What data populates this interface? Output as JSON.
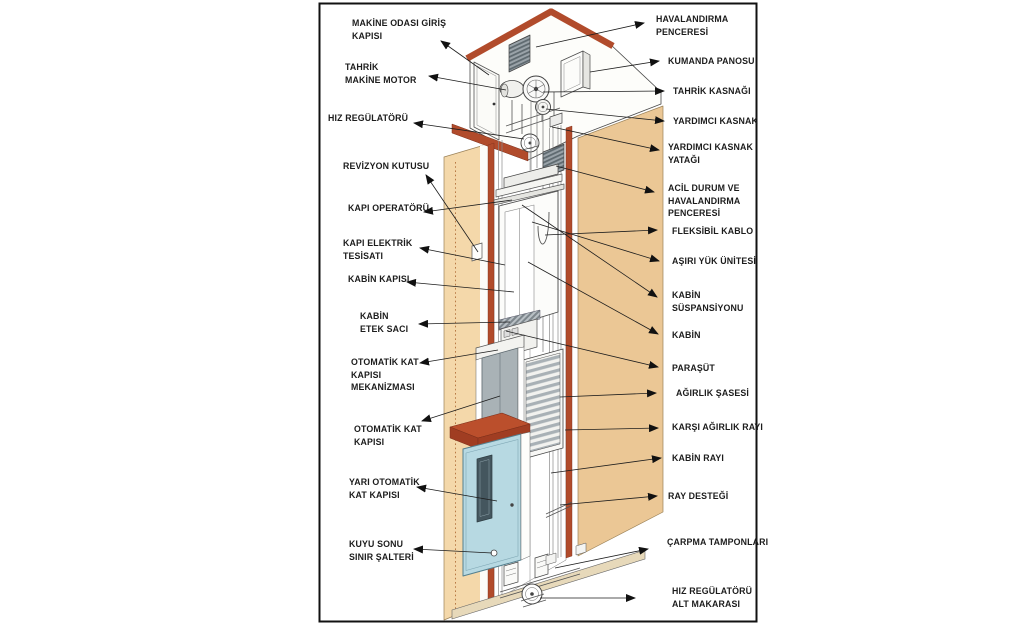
{
  "figure": {
    "type": "elevator-shaft-cutaway-diagram",
    "language": "Turkish",
    "labels_left": [
      {
        "text": "MAKİNE ODASI GİRİŞ\nKAPISI"
      },
      {
        "text": "TAHRİK\nMAKİNE MOTOR"
      },
      {
        "text": "HIZ REGÜLATÖRÜ"
      },
      {
        "text": "REVİZYON KUTUSU"
      },
      {
        "text": "KAPI OPERATÖRÜ"
      },
      {
        "text": "KAPI ELEKTRİK\nTESİSATI"
      },
      {
        "text": "KABİN KAPISI"
      },
      {
        "text": "KABİN\nETEK SACI"
      },
      {
        "text": "OTOMATİK KAT\nKAPISI\nMEKANİZMASI"
      },
      {
        "text": "OTOMATİK KAT\nKAPISI"
      },
      {
        "text": "YARI OTOMATİK\nKAT KAPISI"
      },
      {
        "text": "KUYU SONU\nSINIR ŞALTERİ"
      }
    ],
    "labels_right": [
      {
        "text": "HAVALANDIRMA\nPENCERESİ"
      },
      {
        "text": "KUMANDA PANOSU"
      },
      {
        "text": "TAHRİK KASNAĞI"
      },
      {
        "text": "YARDIMCI KASNAK"
      },
      {
        "text": "YARDIMCI KASNAK\nYATAĞI"
      },
      {
        "text": "ACİL DURUM VE\nHAVALANDIRMA\nPENCERESİ"
      },
      {
        "text": "FLEKSİBİL KABLO"
      },
      {
        "text": "AŞIRI YÜK ÜNİTESİ"
      },
      {
        "text": "KABİN\nSÜSPANSİYONU"
      },
      {
        "text": "KABİN"
      },
      {
        "text": "PARAŞÜT"
      },
      {
        "text": "AĞIRLIK ŞASESİ"
      },
      {
        "text": "KARŞI AĞIRLIK RAYI"
      },
      {
        "text": "KABİN RAYI"
      },
      {
        "text": "RAY DESTEĞİ"
      },
      {
        "text": "ÇARPMA TAMPONLARI"
      },
      {
        "text": "HIZ REGÜLATÖRÜ\nALT MAKARASI"
      }
    ],
    "colors": {
      "wall_tan_left": "#f4d8aa",
      "wall_tan_right": "#ebc795",
      "trim_red": "#b14b2b",
      "door_blue": "#b7d9e2",
      "vent_gray": "#9aa3a9",
      "counterweight_gray": "#a9b1b6",
      "outline": "#444444",
      "label_text": "#1c1c1c"
    }
  }
}
